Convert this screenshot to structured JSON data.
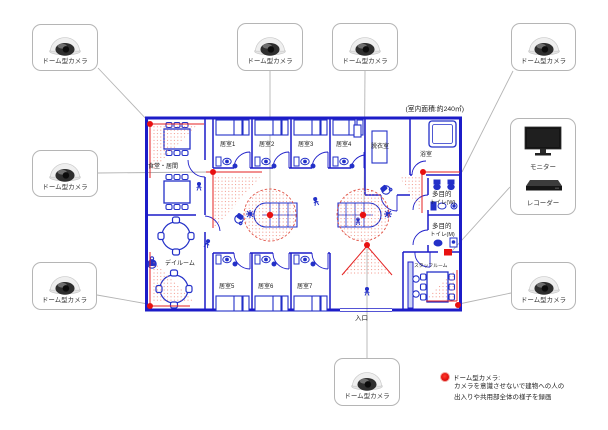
{
  "devices": {
    "dome_camera_label": "ドーム型カメラ",
    "monitor_label": "モニター",
    "recorder_label": "レコーダー"
  },
  "plan": {
    "area_note": "(室内面積:約240㎡)",
    "entrance": "入口",
    "rooms": {
      "dining": "食堂・居間",
      "room1": "居室1",
      "room2": "居室2",
      "room3": "居室3",
      "room4": "居室4",
      "dressing": "脱衣室",
      "bath": "浴室",
      "wc_w_line1": "多目的",
      "wc_w_line2": "トイレ(W)",
      "wc_m_line1": "多目的",
      "wc_m_line2": "トイレ(M)",
      "dayroom": "デイルーム",
      "room5": "居室5",
      "room6": "居室6",
      "room7": "居室7",
      "staff": "スタッフルーム"
    }
  },
  "legend": {
    "title": "ドーム型カメラ:",
    "line1": "カメラを意識させないで建物への人の",
    "line2": "出入りや共用部全体の様子を録画"
  },
  "colors": {
    "plan_blue": "#1c1cc8",
    "camera_red": "#e81010",
    "connector_gray": "#b4b4b4"
  }
}
